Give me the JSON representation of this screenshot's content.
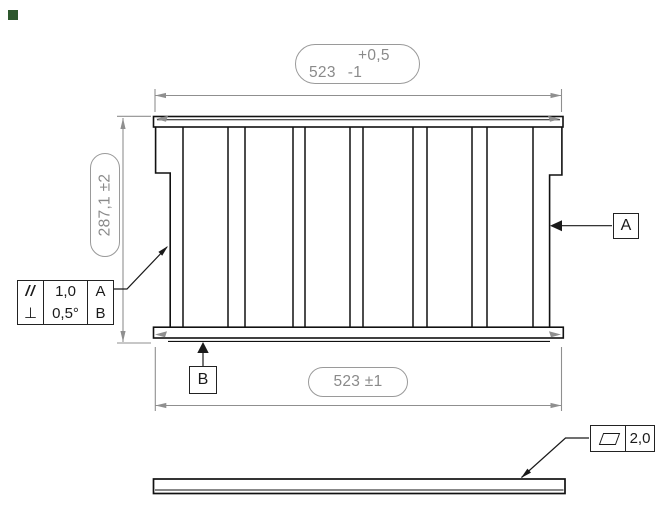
{
  "drawing": {
    "type": "engineering-drawing",
    "views": [
      "front-view-grid-panel",
      "side-view-thin-bar"
    ],
    "colors": {
      "outline": "#111111",
      "dimension": "#8f8f8f",
      "dimension_text": "#8a8a8a",
      "annotation": "#1a1a1a",
      "corner_marker": "#2d572d"
    }
  },
  "dimensions": {
    "width_top": {
      "value": "523",
      "tol_upper": "+0,5",
      "tol_lower": "-1"
    },
    "height_left": {
      "text": "287,1 ±2"
    },
    "width_bottom": {
      "text": "523 ±1"
    }
  },
  "datums": {
    "a": "A",
    "b": "B"
  },
  "feature_controls": {
    "parallelism": {
      "symbol": "//",
      "tolerance": "1,0",
      "datum": "A"
    },
    "perpendicularity": {
      "symbol": "⊥",
      "tolerance": "0,5°",
      "datum": "B"
    },
    "flatness": {
      "symbol_icon": "parallelogram-icon",
      "tolerance": "2,0"
    }
  }
}
